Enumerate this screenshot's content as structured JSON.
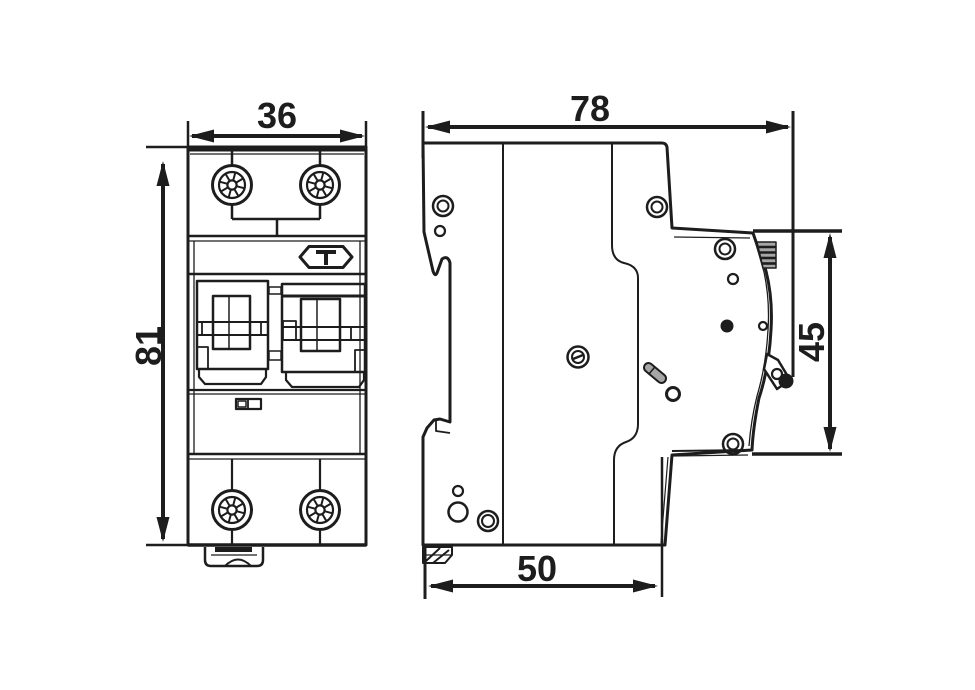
{
  "dimensions": {
    "front_width": "36",
    "front_height": "81",
    "side_depth": "78",
    "side_front_height": "45",
    "side_base_depth": "50"
  },
  "colors": {
    "line": "#1d1d1d",
    "background": "#ffffff",
    "shade": "#a6a6a6"
  }
}
